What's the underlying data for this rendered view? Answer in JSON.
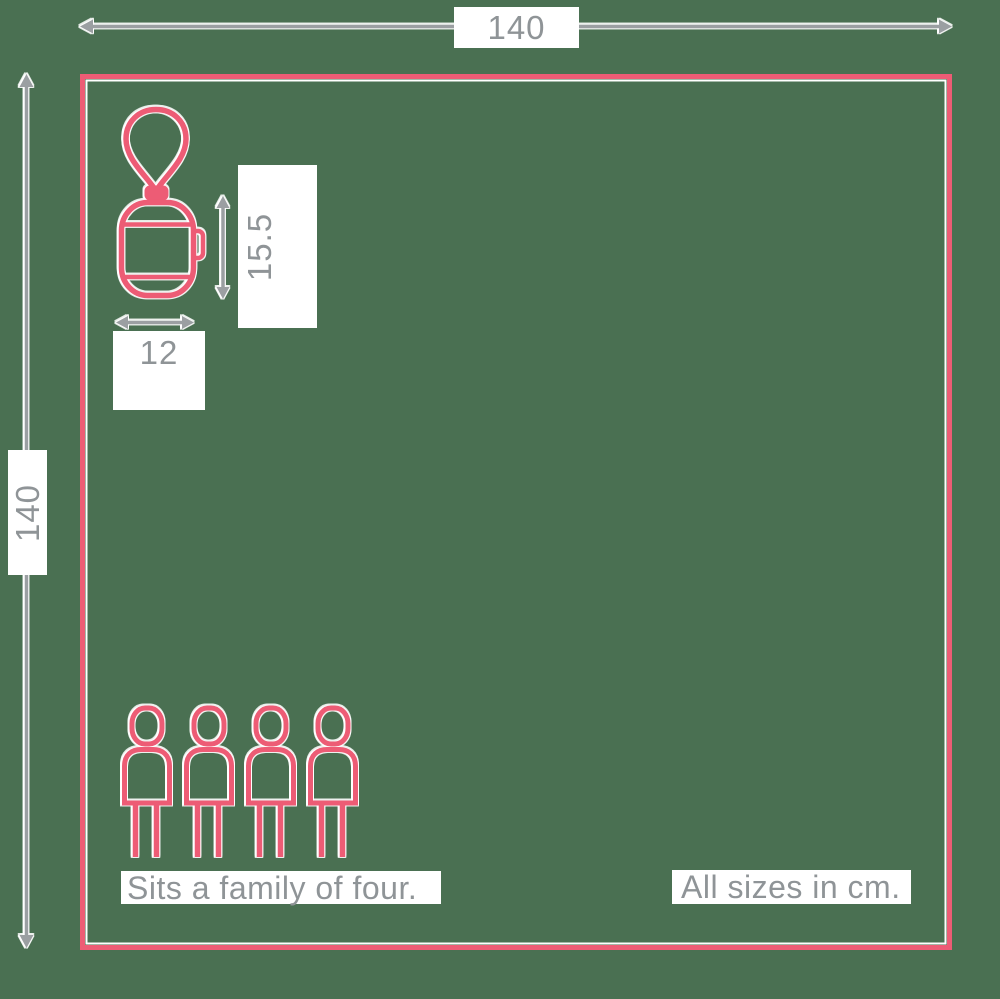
{
  "colors": {
    "background": "#4a7052",
    "outline_pink": "#ed5c75",
    "arrow_gray": "#9b9fa2",
    "label_text": "#8f9497",
    "label_background": "#ffffff"
  },
  "diagram": {
    "outer_width_label": "140",
    "outer_height_label": "140",
    "item_height_label": "15.5",
    "item_width_label": "12",
    "caption_capacity": "Sits a family of four.",
    "caption_units": "All sizes in cm."
  },
  "icons": {
    "lantern": "hanging-lantern-icon",
    "family": "four-person-figures",
    "arrows": [
      "width-extent-arrow",
      "height-extent-arrow",
      "item-height-arrow",
      "item-width-arrow"
    ]
  }
}
